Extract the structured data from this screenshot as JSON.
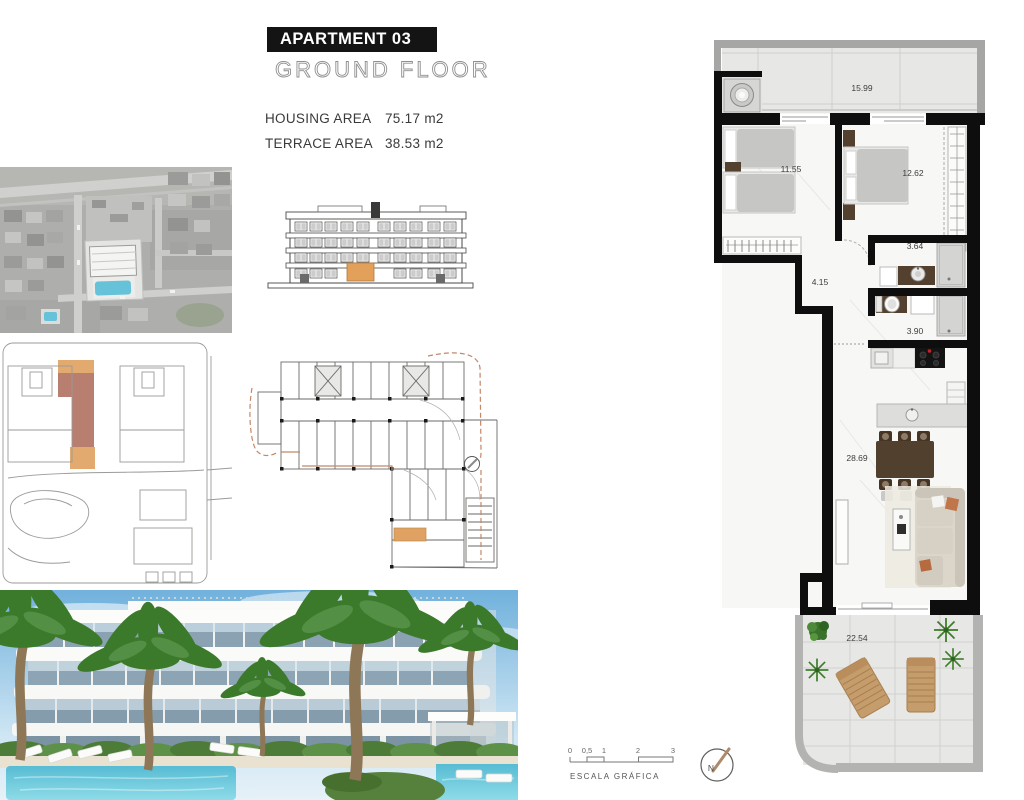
{
  "header": {
    "apartment_title": "APARTMENT 03",
    "floor_subtitle": "GROUND FLOOR",
    "housing_area_label": "HOUSING AREA",
    "housing_area_value": "75.17 m2",
    "terrace_area_label": "TERRACE AREA",
    "terrace_area_value": "38.53 m2"
  },
  "floor_plan": {
    "rooms": [
      {
        "name": "terrace-top",
        "area": "15.99"
      },
      {
        "name": "bedroom-1",
        "area": "11.55"
      },
      {
        "name": "bedroom-2",
        "area": "12.62"
      },
      {
        "name": "bathroom-1",
        "area": "3.64"
      },
      {
        "name": "hallway",
        "area": "4.15"
      },
      {
        "name": "bathroom-2",
        "area": "3.90"
      },
      {
        "name": "living-kitchen",
        "area": "28.69"
      },
      {
        "name": "terrace-bottom",
        "area": "22.54"
      }
    ]
  },
  "scale_bar": {
    "label": "ESCALA GRÁFICA",
    "ticks": [
      "0",
      "0,5",
      "1",
      "2",
      "3"
    ]
  },
  "compass": {
    "north_label": "N"
  },
  "colors": {
    "wall_black": "#0e0e0e",
    "terrace_gray": "#e7e7e5",
    "boundary_gray": "#b3b3b1",
    "highlight_tan": "#e2aa6e",
    "highlight_rose": "#b87e6f",
    "elevation_orange": "#e2a05a",
    "pool_blue": "#66c2d8",
    "wood_dark": "#54402e",
    "lounger_wood": "#c59c6b"
  }
}
